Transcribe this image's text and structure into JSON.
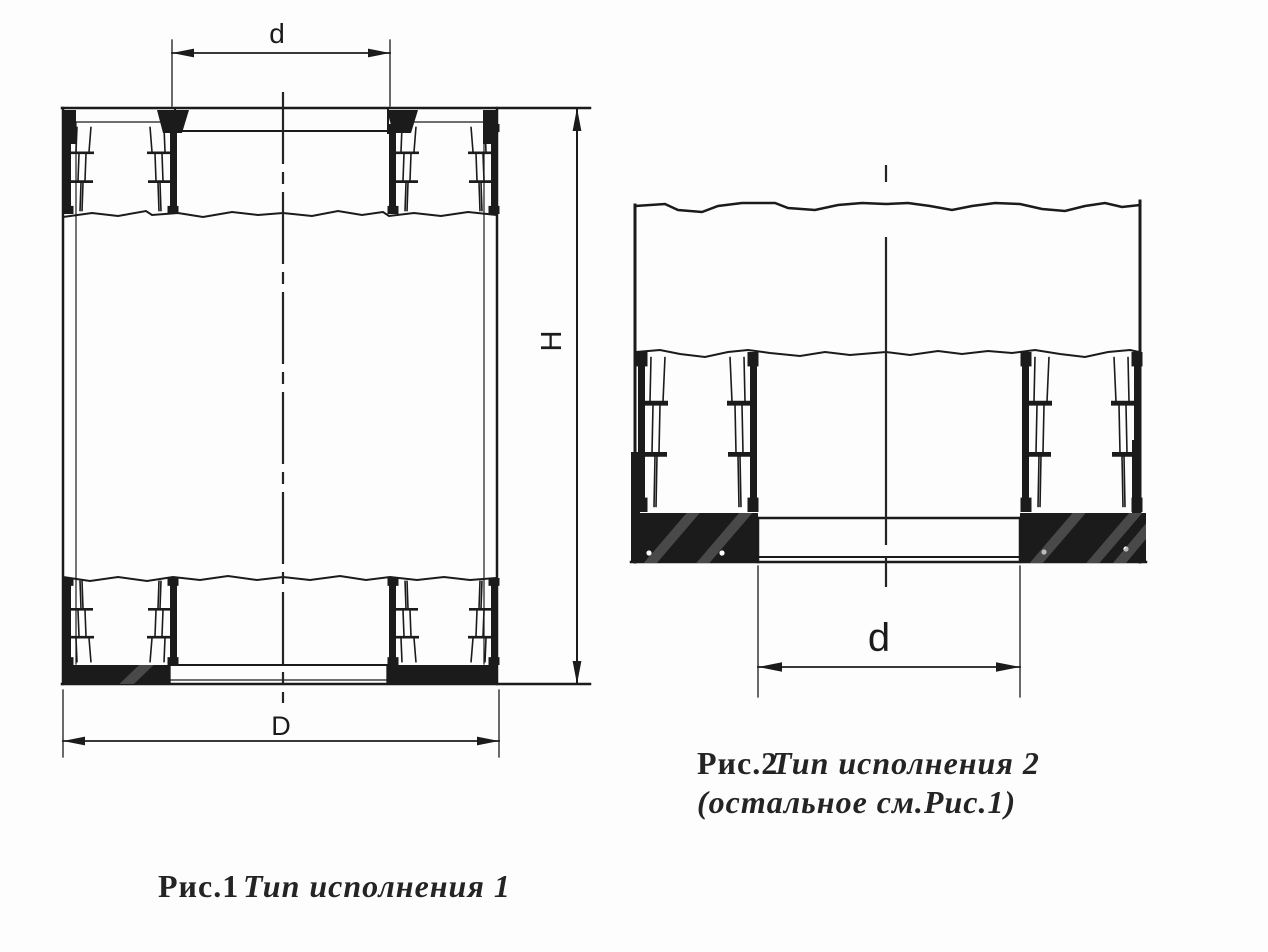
{
  "page": {
    "background": "#fdfdfd",
    "ink_color": "#1b1b1b",
    "type": "technical-drawing"
  },
  "figure1": {
    "caption": {
      "prefix": "Рис.1",
      "italic": "Тип исполнения 1"
    },
    "dimensions": {
      "inner_diameter": "d",
      "outer_diameter": "D",
      "height": "H"
    }
  },
  "figure2": {
    "caption": {
      "prefix": "Рис.2",
      "italic": "Тип исполнения 2",
      "note": "(остальное см.Рис.1)"
    },
    "dimensions": {
      "inner_diameter": "d"
    }
  }
}
